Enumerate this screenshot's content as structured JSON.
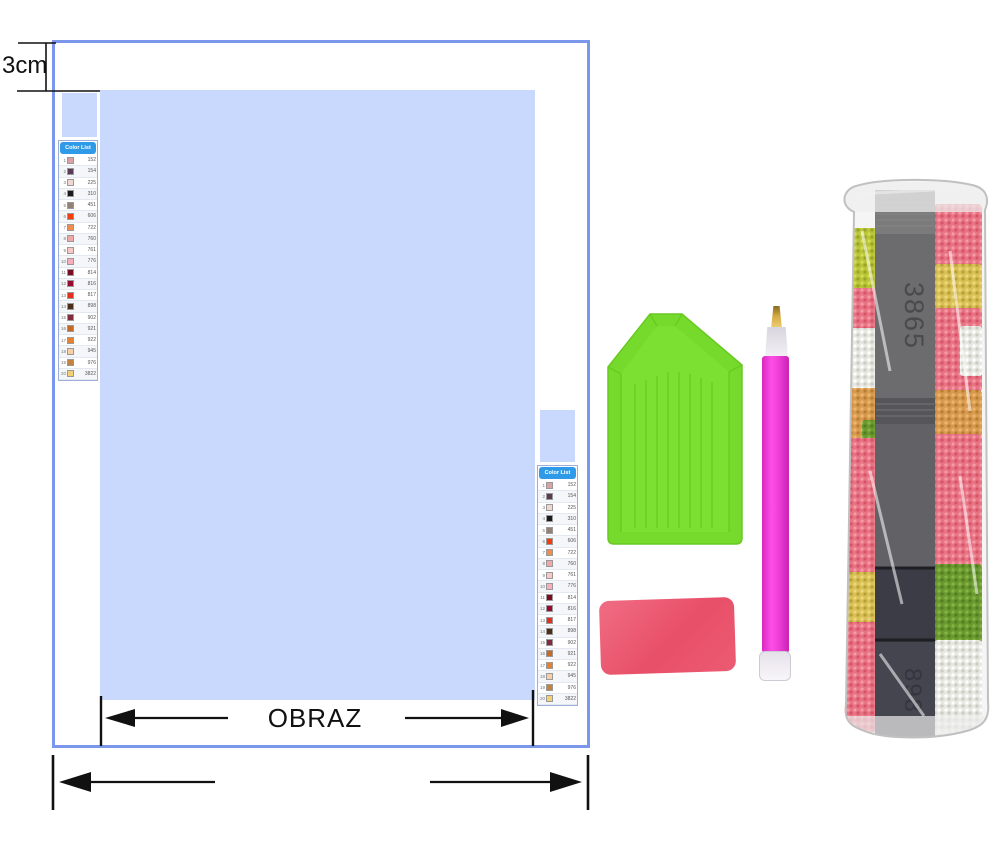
{
  "canvas_diagram": {
    "margin_label": "3cm",
    "picture_label": "OBRAZ",
    "border_color": "#7B97EC",
    "canvas_fill": "#C9D9FE",
    "color_list": {
      "title": "Color List",
      "rows": [
        {
          "no": "1",
          "code": "152",
          "swatch": "#D9A3A6"
        },
        {
          "no": "2",
          "code": "154",
          "swatch": "#5A3B57"
        },
        {
          "no": "3",
          "code": "225",
          "swatch": "#F1D7D2"
        },
        {
          "no": "4",
          "code": "310",
          "swatch": "#1A1A1A"
        },
        {
          "no": "5",
          "code": "451",
          "swatch": "#948176"
        },
        {
          "no": "6",
          "code": "606",
          "swatch": "#F43D0B"
        },
        {
          "no": "7",
          "code": "722",
          "swatch": "#F08D4E"
        },
        {
          "no": "8",
          "code": "760",
          "swatch": "#F1A7A4"
        },
        {
          "no": "9",
          "code": "761",
          "swatch": "#F8C8C5"
        },
        {
          "no": "10",
          "code": "776",
          "swatch": "#F8AFBD"
        },
        {
          "no": "11",
          "code": "814",
          "swatch": "#7C0C22"
        },
        {
          "no": "12",
          "code": "816",
          "swatch": "#99082F"
        },
        {
          "no": "13",
          "code": "817",
          "swatch": "#E2311F"
        },
        {
          "no": "14",
          "code": "898",
          "swatch": "#4C2E18"
        },
        {
          "no": "15",
          "code": "902",
          "swatch": "#832B3E"
        },
        {
          "no": "16",
          "code": "921",
          "swatch": "#C66A23"
        },
        {
          "no": "17",
          "code": "922",
          "swatch": "#E7802F"
        },
        {
          "no": "18",
          "code": "945",
          "swatch": "#F9CFA9"
        },
        {
          "no": "19",
          "code": "976",
          "swatch": "#C4823F"
        },
        {
          "no": "20",
          "code": "3822",
          "swatch": "#F2D173"
        }
      ]
    }
  },
  "kit_items": {
    "tray": {
      "color": "#76DA2C"
    },
    "pen": {
      "body_color": "#F13FD9",
      "tip_color": "#D4AB45"
    },
    "wax": {
      "color": "#E95A70"
    },
    "bag": {
      "label_top": "3865",
      "label_bottom": "898"
    }
  }
}
